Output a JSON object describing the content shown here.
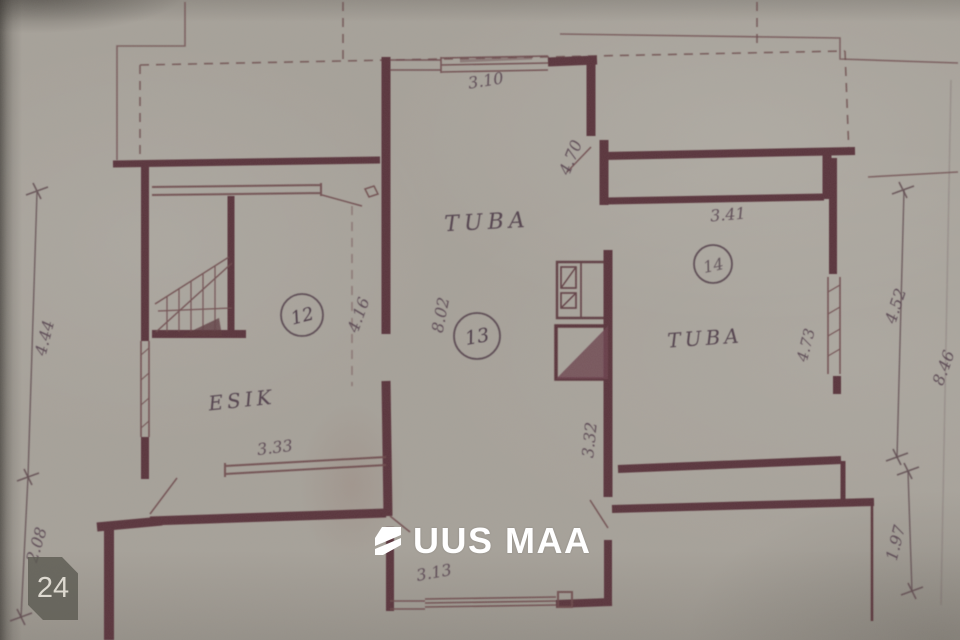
{
  "overlay": {
    "brand": "UUS MAA",
    "brand_color": "#ffffff",
    "badge_label": "24",
    "badge_bg": "#5d5b53"
  },
  "plan": {
    "ink_color": "#5a363c",
    "paper_color": "#a7a29a",
    "rooms": {
      "tuba_center": "TUBA",
      "tuba_right": "TUBA",
      "esik": "ESIK"
    },
    "room_numbers": {
      "n12": "12",
      "n13": "13",
      "n14": "14"
    },
    "dimensions": {
      "top_window": "3.10",
      "corridor_top": "4.70",
      "room14_width": "3.41",
      "left_upper": "4.44",
      "left_lower": "2.08",
      "room12_height": "4.16",
      "room13_depth": "8.02",
      "esik_width": "3.33",
      "passage_width": "3.32",
      "bottom_stub_width": "3.13",
      "room14_depth": "4.73",
      "right_upper": "4.52",
      "right_total": "8.46",
      "bottom_right": "1.97"
    }
  }
}
